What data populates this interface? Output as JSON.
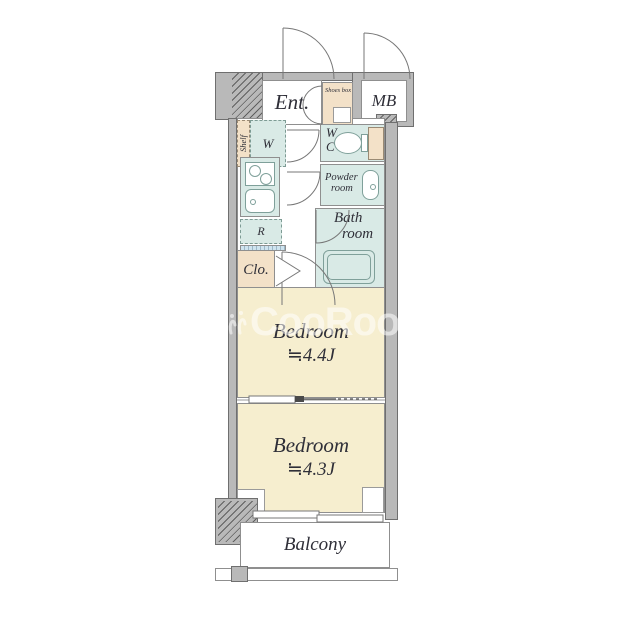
{
  "plan": {
    "watermark": {
      "text": "CooRooM",
      "icon": "bird-mark"
    },
    "rooms": {
      "entrance": {
        "label": "Ent."
      },
      "shoes_box": {
        "label": "Shoes box"
      },
      "meter_box": {
        "label": "MB"
      },
      "shelf": {
        "label": "Shelf"
      },
      "closet_w": {
        "label": "W"
      },
      "wc": {
        "line1": "W",
        "line2": "C"
      },
      "refrigerator": {
        "label": "R"
      },
      "powder_room": {
        "line1": "Powder",
        "line2": "room"
      },
      "bath_room": {
        "line1": "Bath",
        "line2": "room"
      },
      "closet": {
        "label": "Clo."
      },
      "bedroom_1": {
        "label": "Bedroom",
        "size": "≒4.4J"
      },
      "bedroom_2": {
        "label": "Bedroom",
        "size": "≒4.3J"
      },
      "balcony": {
        "label": "Balcony"
      }
    },
    "colors": {
      "wall": "#b9b9b9",
      "wall_outline": "#6f6f6f",
      "floor_cream": "#f6eecf",
      "room_teal": "#d9eae6",
      "cabinet_peach": "#f3e1c8",
      "line": "#777777",
      "ink": "#2f2f38",
      "watermark_color": "rgba(255,255,255,0.55)"
    }
  }
}
